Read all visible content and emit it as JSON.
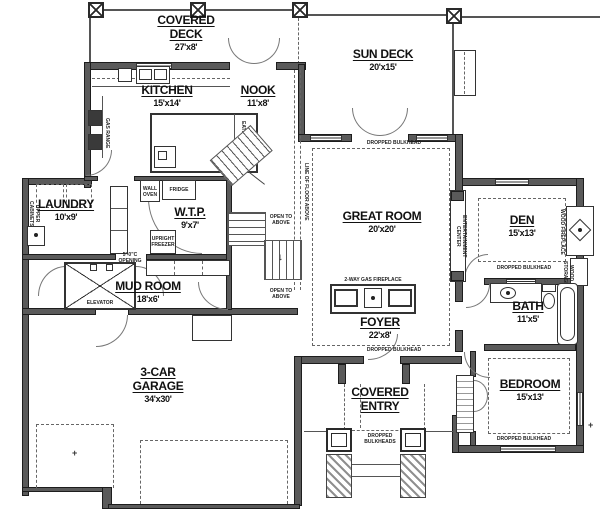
{
  "rooms": {
    "covered_deck": {
      "name": "COVERED DECK",
      "dims": "27'x8'"
    },
    "sun_deck": {
      "name": "SUN DECK",
      "dims": "20'x15'"
    },
    "kitchen": {
      "name": "KITCHEN",
      "dims": "15'x14'"
    },
    "nook": {
      "name": "NOOK",
      "dims": "11'x8'"
    },
    "great_room": {
      "name": "GREAT ROOM",
      "dims": "20'x20'"
    },
    "den": {
      "name": "DEN",
      "dims": "15'x13'"
    },
    "laundry": {
      "name": "LAUNDRY",
      "dims": "10'x9'"
    },
    "wtp": {
      "name": "W.T.P.",
      "dims": "9'x7'"
    },
    "mud_room": {
      "name": "MUD ROOM",
      "dims": "18'x6'"
    },
    "foyer": {
      "name": "FOYER",
      "dims": "22'x8'"
    },
    "bath": {
      "name": "BATH",
      "dims": "11'x5'"
    },
    "bedroom": {
      "name": "BEDROOM",
      "dims": "15'x13'"
    },
    "garage": {
      "name": "3-CAR GARAGE",
      "dims": "34'x30'"
    },
    "covered_entry": {
      "name": "COVERED ENTRY"
    }
  },
  "labels": {
    "dropped_bulkhead": "DROPPED BULKHEAD",
    "dropped_bulkheads": "DROPPED BULKHEADS",
    "gas_fireplace": "2-WAY GAS FIREPLACE",
    "entertainment_center": "ENTERTAINMENT CENTER",
    "wood_fireplace": "WOOD FIREPLACE",
    "wood_storage": "WOOD STORAGE",
    "line_of_floor_above": "LINE OF FLOOR ABOVE",
    "wall_oven": "WALL OVEN",
    "fridge": "FRIDGE",
    "upright_freezer": "UPRIGHT FREEZER",
    "eating_counter": "EATING COUNTER",
    "gas_range": "GAS RANGE",
    "upper_cabinets": "UPPER CABINETS",
    "elevator": "ELEVATOR",
    "open_to_above": "OPEN TO ABOVE",
    "opening": "5'-0\"C OPENING"
  },
  "icons": {
    "stairs_arrow": "↓",
    "dim_tick": "+"
  },
  "colors": {
    "wall": "#5a5a5a",
    "line": "#555555",
    "background": "#ffffff"
  }
}
